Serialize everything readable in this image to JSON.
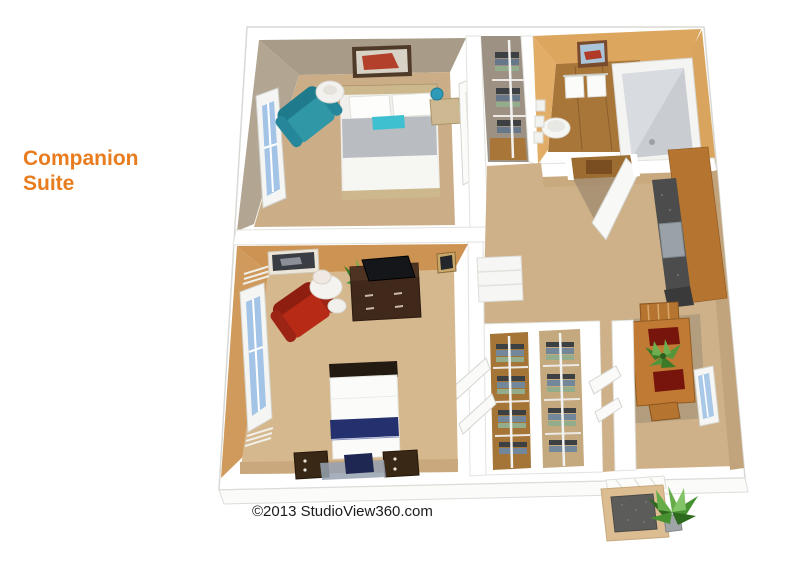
{
  "title": {
    "text": "Companion Suite",
    "color": "#e87c1e"
  },
  "footer": {
    "copyright": "©2013 StudioView360.com",
    "color": "#1c1c1c"
  },
  "floorplan": {
    "kind": "3D birds-eye floor plan rendering",
    "rooms": [
      {
        "name": "bedroom-1",
        "features": [
          "double-bed-gray-blanket",
          "teal-accent-pillow",
          "white-pillows",
          "teal-armchair",
          "floor-lamp",
          "wall-art",
          "nightstand-with-vase",
          "window",
          "open-door"
        ]
      },
      {
        "name": "hall-closet-top",
        "features": [
          "shelves-with-folded-linens",
          "closet-pole"
        ]
      },
      {
        "name": "bathroom",
        "features": [
          "bathtub",
          "round-sink",
          "towel-rack-two-towels",
          "wall-art",
          "wall-dispensers",
          "wood-floor"
        ]
      },
      {
        "name": "living-dining-area",
        "features": [
          "entry-door-open",
          "wood-vestibule-floor",
          "kitchenette-wood-cabinets",
          "dark-countertop",
          "gray-appliance",
          "dining-table",
          "two-chairs",
          "red-placemats",
          "potted-plant",
          "window"
        ]
      },
      {
        "name": "bedroom-2",
        "features": [
          "bed-white-with-navy-stripe",
          "dark-headboard",
          "two-nightstands",
          "navy-cushion",
          "rug",
          "red-armchair",
          "round-side-table",
          "table-lamp",
          "stool",
          "dresser-with-tv",
          "plant",
          "wall-art",
          "small-frame",
          "window-with-blinds",
          "linen-cabinet",
          "bifold-closet-doors"
        ]
      },
      {
        "name": "wardrobe-closet-left",
        "features": [
          "folded-clothes-stacks",
          "closet-pole",
          "shelves"
        ]
      },
      {
        "name": "wardrobe-closet-right",
        "features": [
          "folded-clothes-stacks",
          "closet-pole",
          "shelves"
        ]
      },
      {
        "name": "entry-porch",
        "features": [
          "door-sill",
          "doormat",
          "potted-plant"
        ]
      }
    ],
    "palette": {
      "outer_wall": "#ffffff",
      "bedroom1_wall": "#a89c88",
      "bedroom1_floor": "#cbae88",
      "bedroom2_wall": "#cd9352",
      "bedroom2_floor": "#d6b88e",
      "bathroom_wall": "#dca65e",
      "wood_floor": "#a9763a",
      "living_floor": "#cfb189",
      "cabinet_wood": "#b5742f",
      "counter_dark": "#4c4c4c",
      "teal_chair": "#2f97a6",
      "red_chair": "#b72a16",
      "gray_blanket": "#b9bdc2",
      "teal_pillow": "#3fc0d0",
      "navy_stripe": "#25306e",
      "window_glass": "#a3c4e6",
      "plant_green": "#4e8f3a",
      "doormat_gray": "#5c5c5a"
    }
  }
}
